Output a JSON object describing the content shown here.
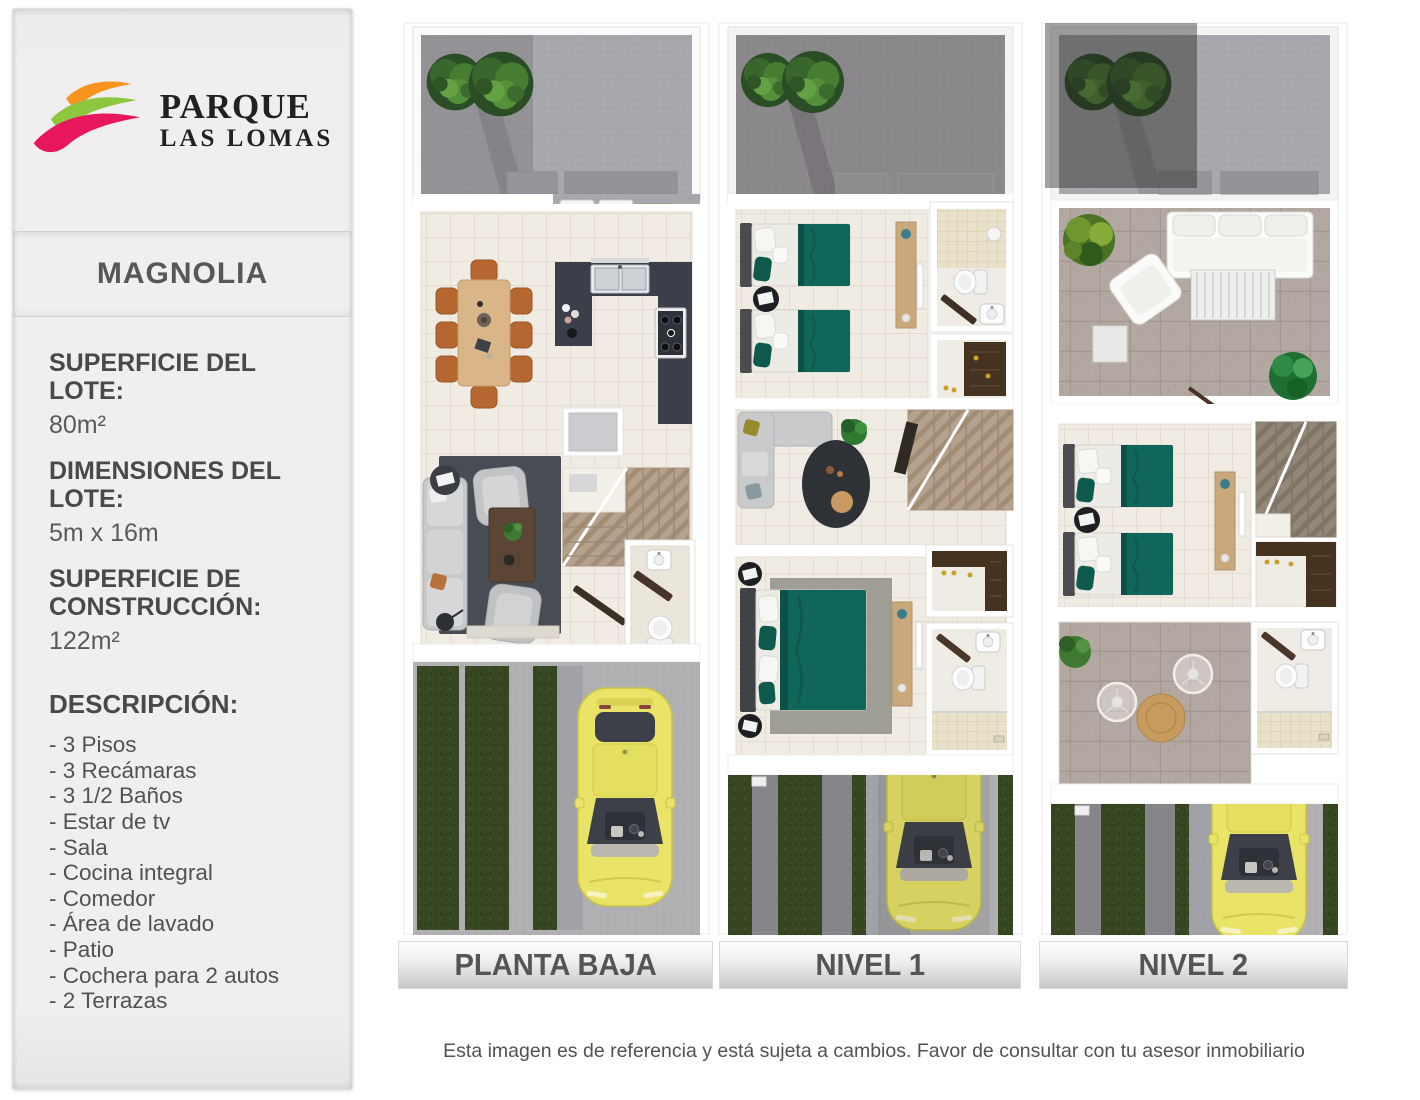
{
  "brand": {
    "line1": "PARQUE",
    "line2": "LAS LOMAS",
    "wave_colors": {
      "orange": "#F7941E",
      "green": "#8DC63F",
      "pink": "#E8175D"
    }
  },
  "sidebar": {
    "model_name": "MAGNOLIA",
    "specs": [
      {
        "label": "SUPERFICIE DEL LOTE:",
        "value": "80m²"
      },
      {
        "label": "DIMENSIONES DEL LOTE:",
        "value": "5m x 16m"
      },
      {
        "label": "SUPERFICIE DE CONSTRUCCIÓN:",
        "value": "122m²"
      }
    ],
    "description": {
      "title": "DESCRIPCIÓN:",
      "items": [
        "- 3 Pisos",
        "- 3 Recámaras",
        "- 3 1/2 Baños",
        "- Estar de tv",
        "- Sala",
        "- Cocina integral",
        "- Comedor",
        "- Área de lavado",
        "- Patio",
        "- Cochera para 2 autos",
        "- 2 Terrazas"
      ]
    }
  },
  "floor_plans": [
    {
      "label": "PLANTA BAJA"
    },
    {
      "label": "NIVEL 1"
    },
    {
      "label": "NIVEL 2"
    }
  ],
  "footer": {
    "disclaimer": "Esta imagen es de referencia y está sujeta a cambios. Favor de consultar con tu asesor inmobiliario"
  }
}
